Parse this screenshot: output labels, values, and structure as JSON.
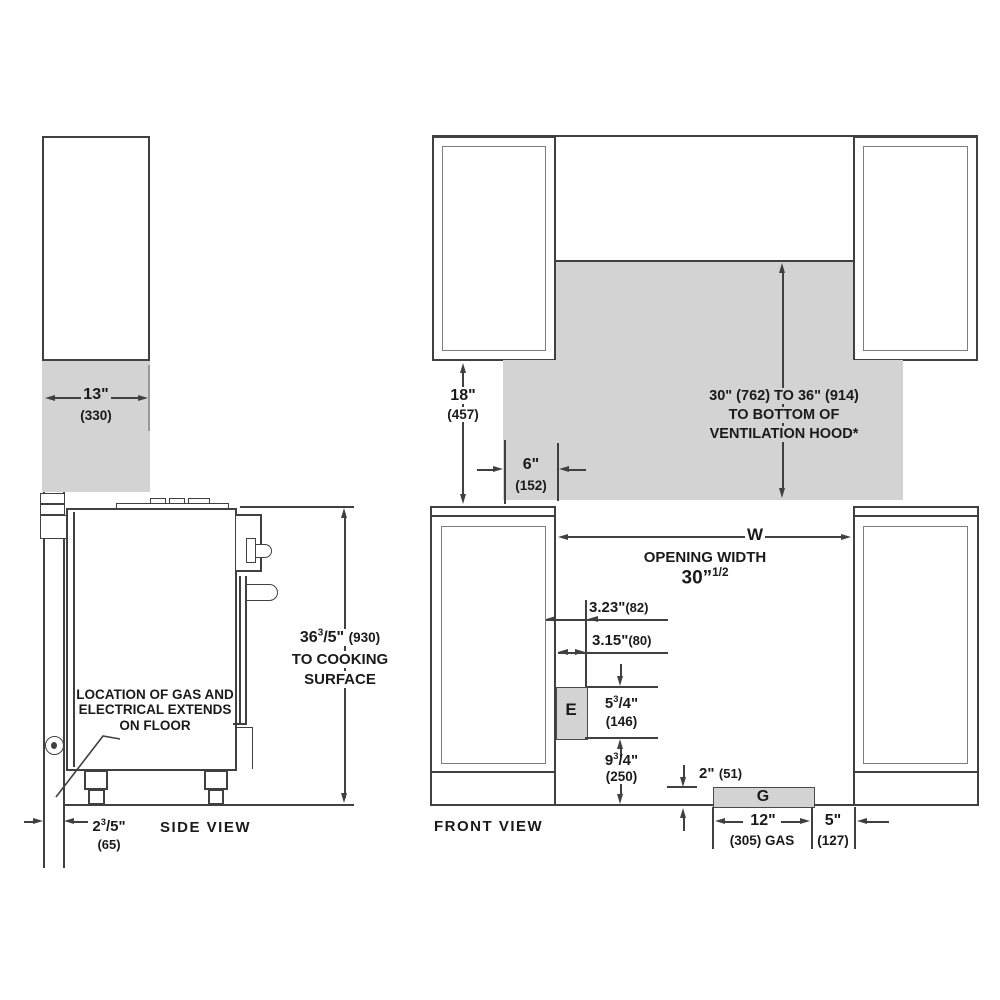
{
  "title": "Range installation clearances diagram",
  "colors": {
    "gray_fill": "#d3d3d3",
    "line": "#404040",
    "text": "#1a1a1a"
  },
  "side_view": {
    "label": "SIDE VIEW",
    "depth": {
      "value": "13\"",
      "metric": "(330)"
    },
    "height": {
      "frac": {
        "int": "36",
        "num": "3",
        "den": "5",
        "unit": "\""
      },
      "metric": "(930)",
      "note1": "TO COOKING",
      "note2": "SURFACE"
    },
    "gap": {
      "frac": {
        "int": "2",
        "num": "3",
        "den": "5",
        "unit": "\""
      },
      "metric": "(65)"
    },
    "note": {
      "line1": "LOCATION OF GAS AND",
      "line2": "ELECTRICAL EXTENDS",
      "line3": "ON FLOOR"
    }
  },
  "front_view": {
    "label": "FRONT VIEW",
    "upper_clearance": {
      "value": "18\"",
      "metric": "(457)"
    },
    "side_clearance": {
      "value": "6\"",
      "metric": "(152)"
    },
    "hood": {
      "line1": "30\" (762) TO 36\" (914)",
      "line2": "TO BOTTOM OF",
      "line3": "VENTILATION HOOD*"
    },
    "opening": {
      "letter": "W",
      "label": "OPENING WIDTH",
      "value": "30”",
      "frac": "1/2"
    },
    "electrical": {
      "letter": "E",
      "offset1": {
        "value": "3.23\"",
        "metric": "(82)"
      },
      "offset2": {
        "value": "3.15\"",
        "metric": "(80)"
      },
      "height": {
        "frac": {
          "int": "5",
          "num": "3",
          "den": "4",
          "unit": "\""
        },
        "metric": "(146)"
      },
      "floor_offset": {
        "frac": {
          "int": "9",
          "num": "3",
          "den": "4",
          "unit": "\""
        },
        "metric": "(250)"
      }
    },
    "gas": {
      "letter": "G",
      "height": {
        "value": "2\"",
        "metric": "(51)"
      },
      "width": {
        "value": "12\"",
        "metric": "(305) GAS"
      },
      "offset": {
        "value": "5\"",
        "metric": "(127)"
      }
    }
  }
}
